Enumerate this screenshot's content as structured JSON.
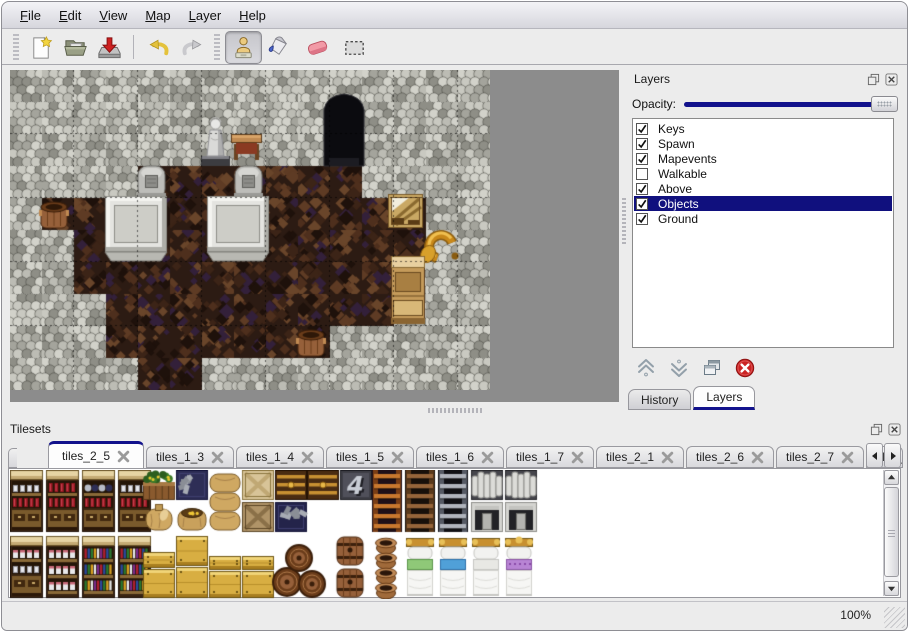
{
  "menu": {
    "items": [
      {
        "label": "File"
      },
      {
        "label": "Edit"
      },
      {
        "label": "View"
      },
      {
        "label": "Map"
      },
      {
        "label": "Layer"
      },
      {
        "label": "Help"
      }
    ]
  },
  "toolbar": {
    "buttons": [
      {
        "name": "new-button",
        "icon": "new-file-icon"
      },
      {
        "name": "open-button",
        "icon": "open-icon"
      },
      {
        "name": "save-button",
        "icon": "save-icon"
      },
      {
        "name": "undo-button",
        "icon": "undo-icon"
      },
      {
        "name": "redo-button",
        "icon": "redo-icon"
      }
    ],
    "tools": [
      {
        "name": "stamp-tool-button",
        "icon": "stamp-icon",
        "active": true
      },
      {
        "name": "fill-tool-button",
        "icon": "fill-icon",
        "active": false
      },
      {
        "name": "eraser-tool-button",
        "icon": "eraser-icon",
        "active": false
      },
      {
        "name": "select-tool-button",
        "icon": "select-icon",
        "active": false
      }
    ]
  },
  "map": {
    "tile_size": 32,
    "width_tiles": 15,
    "height_tiles": 10,
    "grid": [
      "WWWWWWWWWWWWWWW",
      "WWWWWWWWWWWWWWW",
      "WWWWWWWWWWWWWWW",
      "WWWWFFFFFFFWWWW",
      "WFFFFFFFFFFFFWW",
      "WWFFFFFFFFFFFWW",
      "WWFFFFFFFFFFWWW",
      "WWWFFFFFFFFFWWW",
      "WWWFFFFFFFWWWWW",
      "WWWWFFWWWWWWWWW"
    ],
    "objects": [
      {
        "type": "cave",
        "x": 314,
        "y": 24
      },
      {
        "type": "statue",
        "x": 190,
        "y": 46
      },
      {
        "type": "table",
        "x": 221,
        "y": 64
      },
      {
        "type": "gravestone",
        "x": 128,
        "y": 96
      },
      {
        "type": "gravestone",
        "x": 225,
        "y": 96
      },
      {
        "type": "slab",
        "x": 95,
        "y": 126
      },
      {
        "type": "slab",
        "x": 197,
        "y": 126
      },
      {
        "type": "barrel",
        "x": 28,
        "y": 128
      },
      {
        "type": "broken-crate",
        "x": 378,
        "y": 124
      },
      {
        "type": "horn",
        "x": 410,
        "y": 158
      },
      {
        "type": "cabinet",
        "x": 381,
        "y": 186
      },
      {
        "type": "barrel",
        "x": 285,
        "y": 256
      }
    ]
  },
  "layers_panel": {
    "title": "Layers",
    "opacity_label": "Opacity:",
    "opacity_value": 100,
    "layers": [
      {
        "name": "Keys",
        "checked": true,
        "selected": false
      },
      {
        "name": "Spawn",
        "checked": true,
        "selected": false
      },
      {
        "name": "Mapevents",
        "checked": true,
        "selected": false
      },
      {
        "name": "Walkable",
        "checked": false,
        "selected": false
      },
      {
        "name": "Above",
        "checked": true,
        "selected": false
      },
      {
        "name": "Objects",
        "checked": true,
        "selected": true
      },
      {
        "name": "Ground",
        "checked": true,
        "selected": false
      }
    ],
    "actions": [
      {
        "name": "layer-up-button",
        "icon": "arrow-up-icon"
      },
      {
        "name": "layer-down-button",
        "icon": "arrow-down-icon"
      },
      {
        "name": "layer-duplicate-button",
        "icon": "duplicate-icon"
      },
      {
        "name": "layer-delete-button",
        "icon": "delete-icon"
      }
    ],
    "tabs": [
      {
        "label": "History",
        "active": false
      },
      {
        "label": "Layers",
        "active": true
      }
    ]
  },
  "tilesets_panel": {
    "title": "Tilesets",
    "tabs": [
      {
        "label": "tiles_2_5",
        "active": true
      },
      {
        "label": "tiles_1_3",
        "active": false
      },
      {
        "label": "tiles_1_4",
        "active": false
      },
      {
        "label": "tiles_1_5",
        "active": false
      },
      {
        "label": "tiles_1_6",
        "active": false
      },
      {
        "label": "tiles_1_7",
        "active": false
      },
      {
        "label": "tiles_2_1",
        "active": false
      },
      {
        "label": "tiles_2_6",
        "active": false
      },
      {
        "label": "tiles_2_7",
        "active": false
      },
      {
        "label": "tiles_",
        "active": false,
        "truncated": true
      }
    ],
    "tiles": [
      {
        "t": "shelf",
        "x": 0,
        "y": 0,
        "v": "dishes"
      },
      {
        "t": "shelf",
        "x": 36,
        "y": 0,
        "v": "wine"
      },
      {
        "t": "shelf",
        "x": 72,
        "y": 0,
        "v": "blue"
      },
      {
        "t": "shelf",
        "x": 108,
        "y": 0,
        "v": "jars"
      },
      {
        "t": "plantbox",
        "x": 133,
        "y": 0
      },
      {
        "t": "orebox",
        "x": 166,
        "y": 0,
        "v": "navy"
      },
      {
        "t": "sackpile",
        "x": 199,
        "y": 0
      },
      {
        "t": "xcrate",
        "x": 232,
        "y": 0,
        "v": "light"
      },
      {
        "t": "chest",
        "x": 265,
        "y": 0
      },
      {
        "t": "chest",
        "x": 297,
        "y": 0
      },
      {
        "t": "logo4",
        "x": 330,
        "y": 0,
        "label": "4"
      },
      {
        "t": "sack",
        "x": 133,
        "y": 32
      },
      {
        "t": "opensack",
        "x": 166,
        "y": 32
      },
      {
        "t": "xcrate",
        "x": 232,
        "y": 32,
        "v": "dark"
      },
      {
        "t": "orebox",
        "x": 265,
        "y": 32,
        "v": "blue"
      },
      {
        "t": "ladder",
        "x": 362,
        "y": 0,
        "v": "brown"
      },
      {
        "t": "ladder",
        "x": 395,
        "y": 0,
        "v": "darkbrown"
      },
      {
        "t": "ladder",
        "x": 428,
        "y": 0,
        "v": "gray"
      },
      {
        "t": "stonefrag",
        "x": 461,
        "y": 0
      },
      {
        "t": "stonefrag",
        "x": 495,
        "y": 0
      },
      {
        "t": "stonedoor",
        "x": 461,
        "y": 32
      },
      {
        "t": "stonedoor",
        "x": 495,
        "y": 32
      },
      {
        "t": "shelf",
        "x": 0,
        "y": 66,
        "v": "pantry"
      },
      {
        "t": "bookshelf",
        "x": 36,
        "y": 66,
        "v": "b1"
      },
      {
        "t": "bookshelf",
        "x": 72,
        "y": 66,
        "v": "b2"
      },
      {
        "t": "bookshelf",
        "x": 108,
        "y": 66,
        "v": "b3"
      },
      {
        "t": "ycrate",
        "x": 133,
        "y": 82,
        "h": 16
      },
      {
        "t": "ycrate",
        "x": 133,
        "y": 99,
        "h": 29
      },
      {
        "t": "ycrate",
        "x": 166,
        "y": 66,
        "h": 30
      },
      {
        "t": "ycrate",
        "x": 166,
        "y": 97,
        "h": 31
      },
      {
        "t": "ycrate",
        "x": 199,
        "y": 86,
        "h": 14
      },
      {
        "t": "ycrate",
        "x": 199,
        "y": 101,
        "h": 27
      },
      {
        "t": "ycrate",
        "x": 232,
        "y": 86,
        "h": 14
      },
      {
        "t": "ycrate",
        "x": 232,
        "y": 101,
        "h": 27
      },
      {
        "t": "barrelpile",
        "x": 262,
        "y": 66
      },
      {
        "t": "barrels2",
        "x": 325,
        "y": 66
      },
      {
        "t": "pots",
        "x": 362,
        "y": 66
      },
      {
        "t": "bed",
        "x": 395,
        "y": 66,
        "v": "green"
      },
      {
        "t": "bed",
        "x": 428,
        "y": 66,
        "v": "blue"
      },
      {
        "t": "bed",
        "x": 461,
        "y": 66,
        "v": "plain"
      },
      {
        "t": "bed",
        "x": 494,
        "y": 66,
        "v": "purple"
      }
    ]
  },
  "statusbar": {
    "zoom": "100%"
  },
  "colors": {
    "accent": "#12128c",
    "selection_bg": "#10107e",
    "wall_base": "#b2b2aa",
    "floor_base": "#2c1b13"
  }
}
